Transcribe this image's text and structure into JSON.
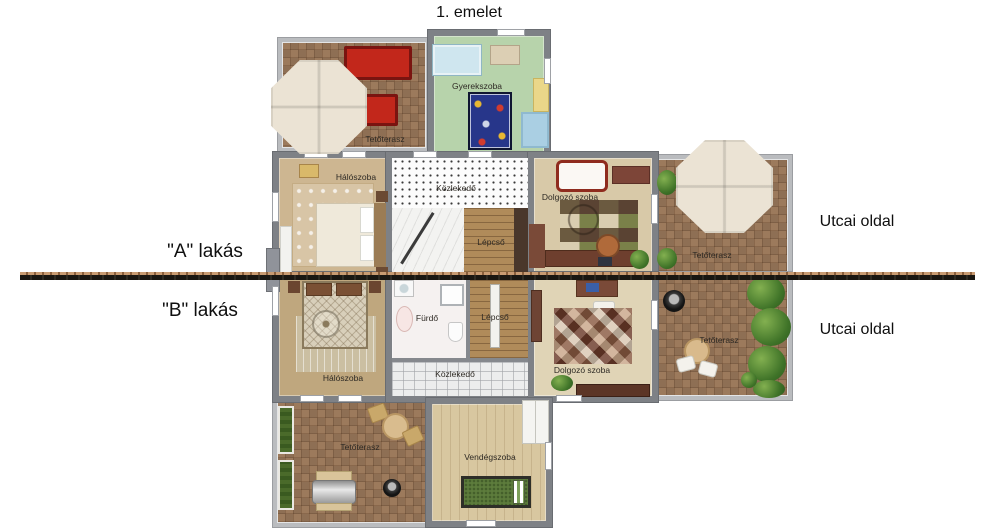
{
  "title": "1. emelet",
  "side_labels": {
    "apartment_a": "\"A\" lakás",
    "apartment_b": "\"B\" lakás",
    "street_top": "Utcai oldal",
    "street_bottom": "Utcai oldal"
  },
  "rooms": {
    "terrace_top_left": "Tetőterasz",
    "children_room": "Gyerekszoba",
    "bedroom_a": "Hálószoba",
    "hallway_a": "Közlekedő",
    "stairs_a": "Lépcső",
    "study_a": "Dolgozó szoba",
    "terrace_right_a": "Tetőterasz",
    "bedroom_b": "Hálószoba",
    "bathroom": "Fürdő",
    "stairs_b": "Lépcső",
    "hallway_b": "Közlekedő",
    "study_b": "Dolgozó szoba",
    "terrace_right_b": "Tetőterasz",
    "terrace_bottom_left": "Tetőterasz",
    "guest_room": "Vendégszoba"
  },
  "colors": {
    "wall": "#7e8186",
    "terrace_railing": "#babcbf",
    "parquet": "#9c7a5c",
    "children_floor": "#b7d3ab",
    "divider_tan": "#c89b72",
    "divider_dark": "#191611",
    "sofa_red": "#c2271b",
    "play_rug_blue": "#27368a",
    "guest_bed_green": "#5d7c3c"
  }
}
